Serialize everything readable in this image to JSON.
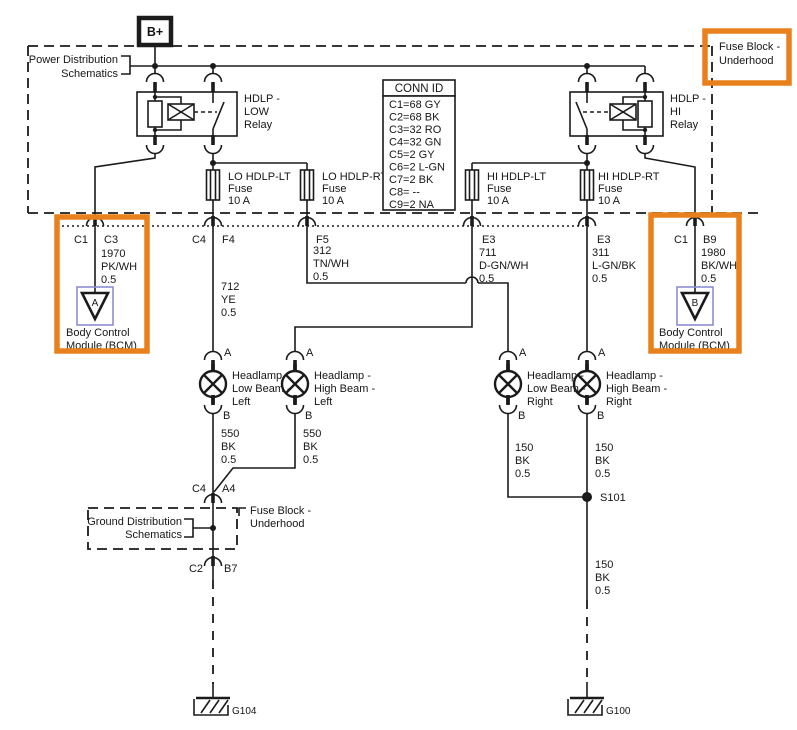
{
  "labels": {
    "battery": "B+",
    "power_distribution": [
      "Power Distribution",
      "Schematics"
    ],
    "fuse_block_top": [
      "Fuse Block -",
      "Underhood"
    ],
    "fuse_block_mid": [
      "Fuse Block -",
      "Underhood"
    ],
    "ground_distribution": [
      "Ground Distribution",
      "Schematics"
    ]
  },
  "relays": {
    "low": [
      "HDLP -",
      "LOW",
      "Relay"
    ],
    "hi": [
      "HDLP -",
      "HI",
      "Relay"
    ]
  },
  "conn_id": {
    "title": "CONN ID",
    "rows": [
      "C1=68 GY",
      "C2=68 BK",
      "C3=32 RO",
      "C4=32 GN",
      "C5=2 GY",
      "C6=2 L-GN",
      "C7=2 BK",
      "C8= --",
      "C9=2 NA"
    ]
  },
  "fuses": {
    "lo_lt": [
      "LO HDLP-LT",
      "Fuse",
      "10 A"
    ],
    "lo_rt": [
      "LO HDLP-RT",
      "Fuse",
      "10 A"
    ],
    "hi_lt": [
      "HI HDLP-LT",
      "Fuse",
      "10 A"
    ],
    "hi_rt": [
      "HI HDLP-RT",
      "Fuse",
      "10 A"
    ]
  },
  "pins": {
    "bcm_left": [
      "C1",
      "C3"
    ],
    "lo_lt": [
      "C4",
      "F4"
    ],
    "lo_rt": [
      "F5"
    ],
    "hi_lt": [
      "E3"
    ],
    "hi_rt": [
      "E3"
    ],
    "bcm_right": [
      "C1",
      "B9"
    ],
    "fuse_block_in": [
      "C4",
      "A4"
    ],
    "fuse_block_out": [
      "C2",
      "B7"
    ],
    "lamp_a": "A",
    "lamp_b": "B"
  },
  "wires": {
    "w1970": [
      "1970",
      "PK/WH",
      "0.5"
    ],
    "w712": [
      "712",
      "YE",
      "0.5"
    ],
    "w312": [
      "312",
      "TN/WH",
      "0.5"
    ],
    "w711": [
      "711",
      "D-GN/WH",
      "0.5"
    ],
    "w311": [
      "311",
      "L-GN/BK",
      "0.5"
    ],
    "w1980": [
      "1980",
      "BK/WH",
      "0.5"
    ],
    "w550_left": [
      "550",
      "BK",
      "0.5"
    ],
    "w550_right": [
      "550",
      "BK",
      "0.5"
    ],
    "w150_low": [
      "150",
      "BK",
      "0.5"
    ],
    "w150_high": [
      "150",
      "BK",
      "0.5"
    ],
    "w150_bottom": [
      "150",
      "BK",
      "0.5"
    ]
  },
  "headlamps": {
    "low_left": [
      "Headlamp -",
      "Low Beam -",
      "Left"
    ],
    "high_left": [
      "Headlamp -",
      "High Beam -",
      "Left"
    ],
    "low_right": [
      "Headlamp -",
      "Low Beam -",
      "Right"
    ],
    "high_right": [
      "Headlamp -",
      "High Beam -",
      "Right"
    ]
  },
  "bcm": {
    "left_id": "A",
    "right_id": "B",
    "label": [
      "Body Control",
      "Module (BCM)"
    ]
  },
  "splice": "S101",
  "grounds": {
    "left": "G104",
    "right": "G100"
  },
  "colors": {
    "highlight": "#e8811c",
    "module_box": "#8d8dd4",
    "line": "#1b1b1b"
  }
}
